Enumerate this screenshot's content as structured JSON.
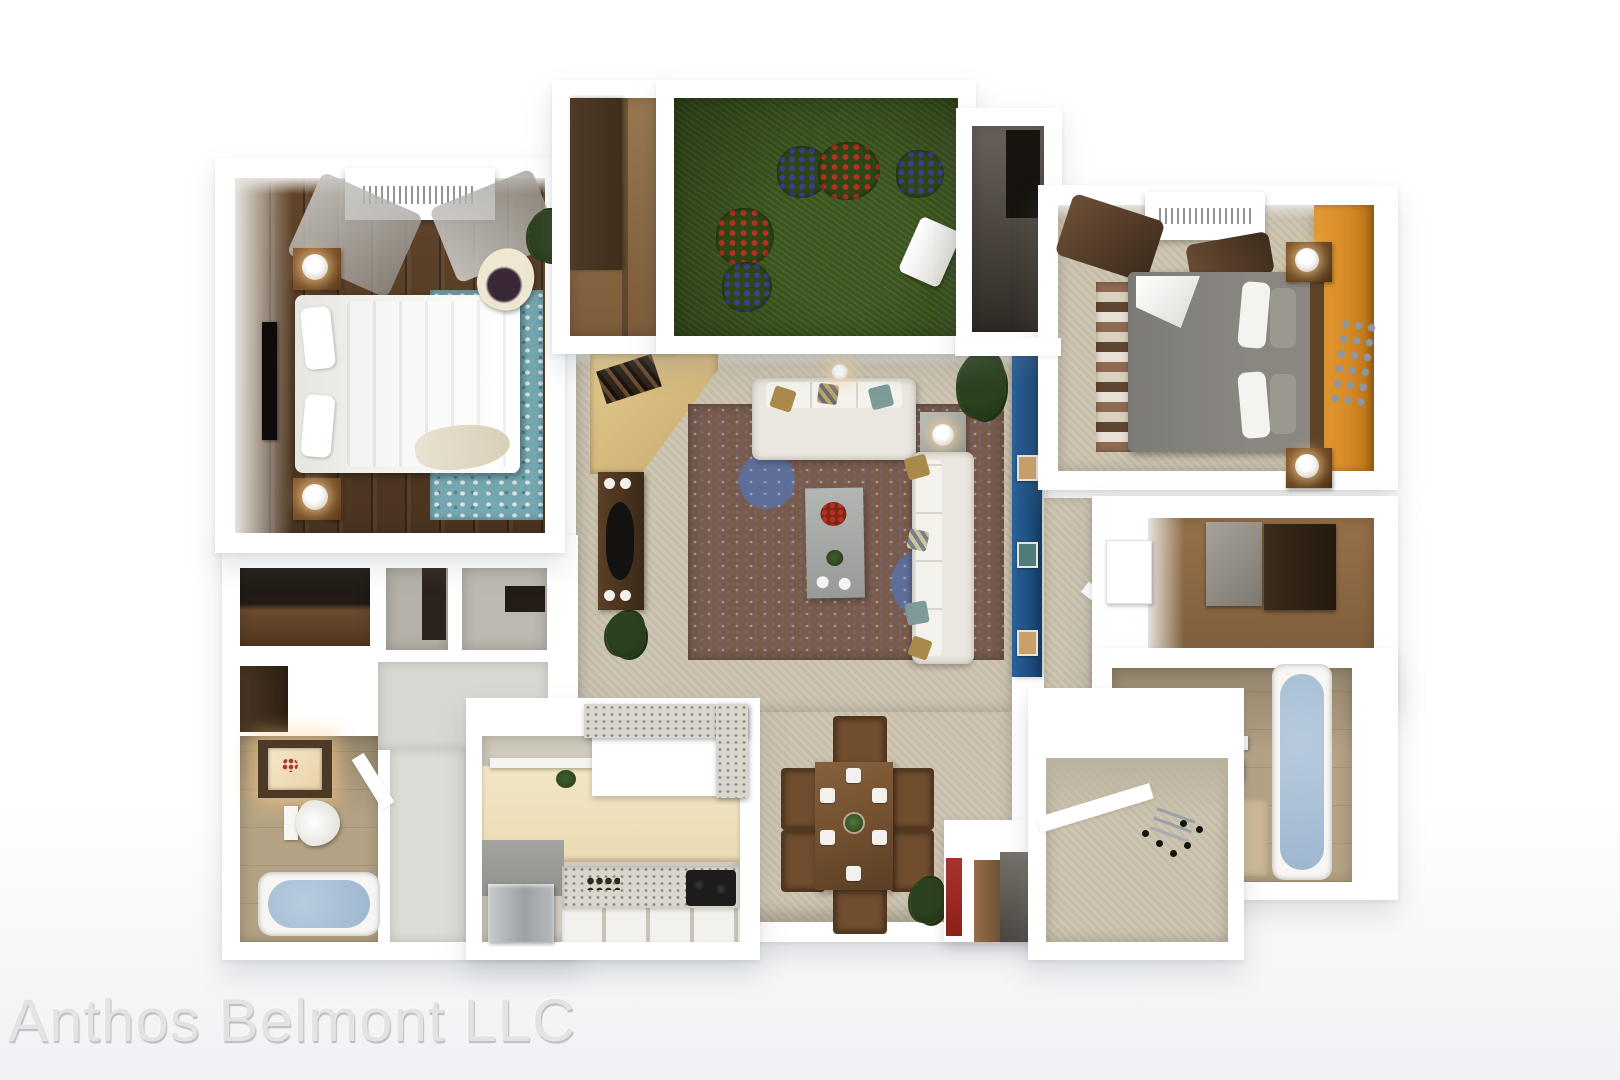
{
  "watermark": {
    "text": "Anthos Belmont LLC"
  },
  "legend": [
    "master-bedroom",
    "walk-in-closet-top",
    "patio-garden",
    "utility-closet",
    "bedroom-2",
    "living-room",
    "dining-area",
    "kitchen",
    "hallway",
    "bathroom-1",
    "bathroom-2",
    "walk-in-closet-right",
    "entry-hall"
  ],
  "palette": {
    "page_top": "#ffffff",
    "page_bottom": "#eff1f4",
    "wall": "#ffffff",
    "wall_face": "#e7e4de",
    "wall_edge": "#dad8d2",
    "wood_floor": "#4a3420",
    "wood_floor_hi": "#5f4429",
    "wood_mid": "#8a6743",
    "wood_dark": "#33261a",
    "carpet": "#cbc3ae",
    "carpet_shade": "#b7af99",
    "grass": "#3f5a20",
    "grass_dark": "#2e4516",
    "flower_red": "#b5311f",
    "flower_blue": "#3a3f92",
    "orange": "#d78b28",
    "navy": "#1d4d7e",
    "teal_rug": "#74a7b0",
    "rug_base": "#7b5a49",
    "rug_blue": "#5d6f99",
    "rug_cream": "#d8cdbc",
    "bed_white": "#f3f2ef",
    "bed_gray": "#8a8781",
    "bed_gray_dark": "#76736d",
    "sofa": "#eae7df",
    "pillow_gold": "#a98a4a",
    "pillow_teal": "#7e9a99",
    "table_gray": "#a5a8a4",
    "lamp_white": "#f6f5f2",
    "dining_wood": "#6f4d2e",
    "dining_dark": "#53381f",
    "tile": "#b4a284",
    "tile_light": "#cdb997",
    "tub": "#9db7cf",
    "porcelain": "#f7f6f3",
    "backsplash": "#ebdab3",
    "counter": "#90908c",
    "stainless": "#b2b5b7",
    "marble": "#d9d6ce",
    "marble_fleck": "#8a8a86",
    "plant": "#2c421f",
    "plant_dark": "#1f3115",
    "red_obj": "#8e201a",
    "black": "#141210",
    "tv": "#0d0c0b",
    "watermark": "#e3e3e5",
    "watermark_shadow": "#bcbcbe"
  }
}
